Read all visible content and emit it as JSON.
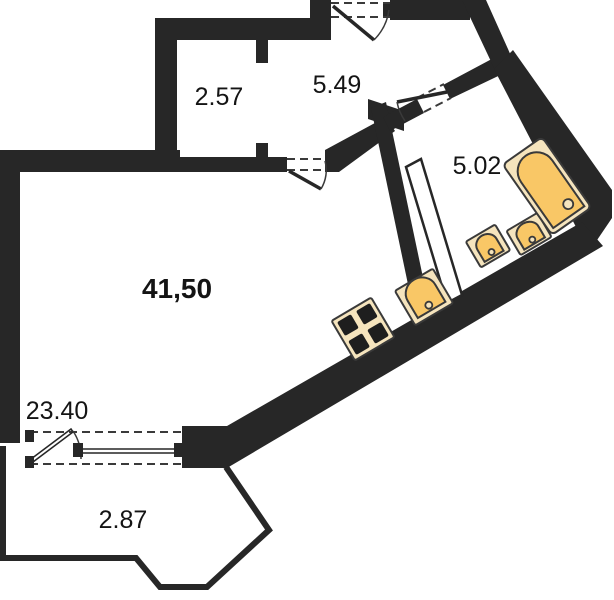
{
  "plan": {
    "type": "apartment-floor-plan",
    "labels": {
      "wardrobe": "2.57",
      "hall": "5.49",
      "bathroom": "5.02",
      "total": "41,50",
      "room": "23.40",
      "balcony": "2.87"
    },
    "colors": {
      "wall": "#272727",
      "line": "#3a3a3a",
      "fixture": "#f9c766",
      "cream": "#f5e4bd",
      "burner": "#1e1e1e",
      "label": "#141414",
      "bg": "#ffffff"
    },
    "fixtures": [
      "bathtub",
      "sink",
      "sink",
      "kitchen-sink",
      "stove"
    ],
    "doors": [
      "entrance-door",
      "room-door",
      "bathroom-door",
      "balcony-door"
    ],
    "windows": [
      "balcony-window"
    ]
  }
}
